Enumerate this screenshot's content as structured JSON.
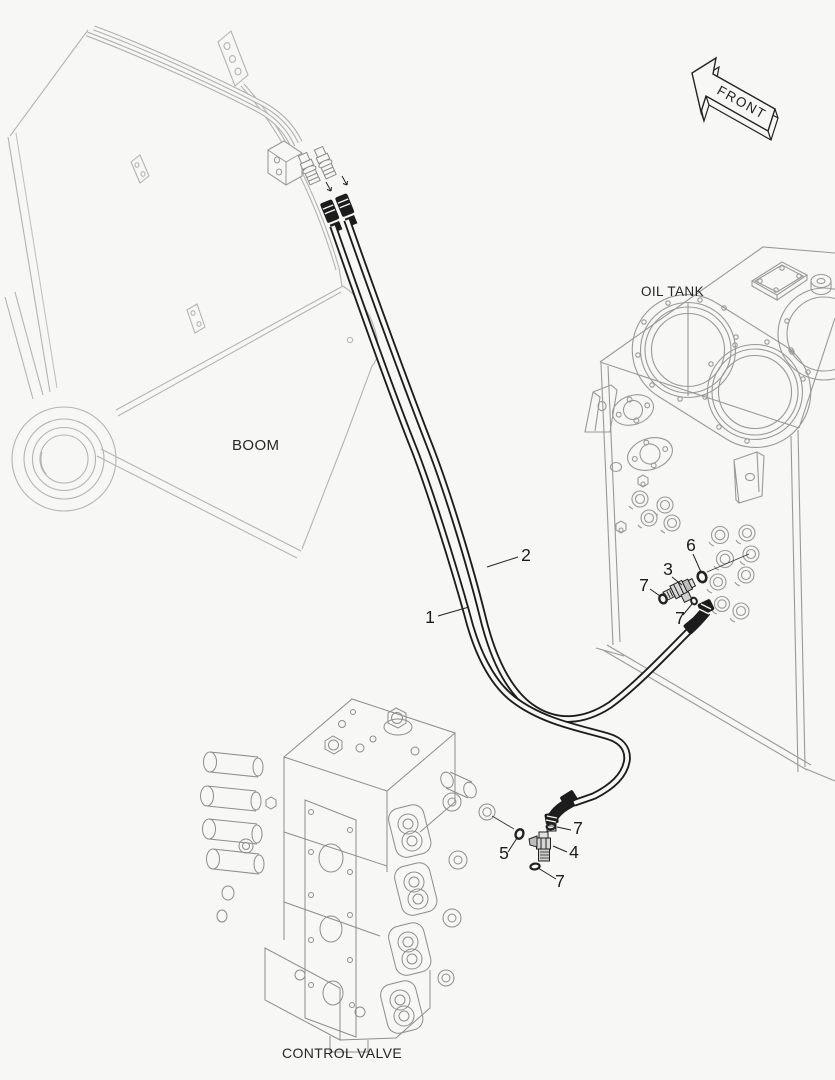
{
  "labels": {
    "boom": "BOOM",
    "oil_tank": "OIL TANK",
    "control_valve": "CONTROL VALVE"
  },
  "front_arrow": {
    "label": "FRONT"
  },
  "callouts": [
    {
      "number": "1"
    },
    {
      "number": "2"
    },
    {
      "number": "3"
    },
    {
      "number": "6"
    },
    {
      "number": "7"
    },
    {
      "number": "7"
    },
    {
      "number": "7"
    },
    {
      "number": "4"
    },
    {
      "number": "5"
    },
    {
      "number": "7"
    }
  ],
  "colors": {
    "background": "#f7f7f6",
    "outline_dark": "#1c1c1c",
    "boom_gray": "#b4b4b4",
    "tank_gray": "#999999",
    "valve_gray": "#8d8d8d"
  }
}
